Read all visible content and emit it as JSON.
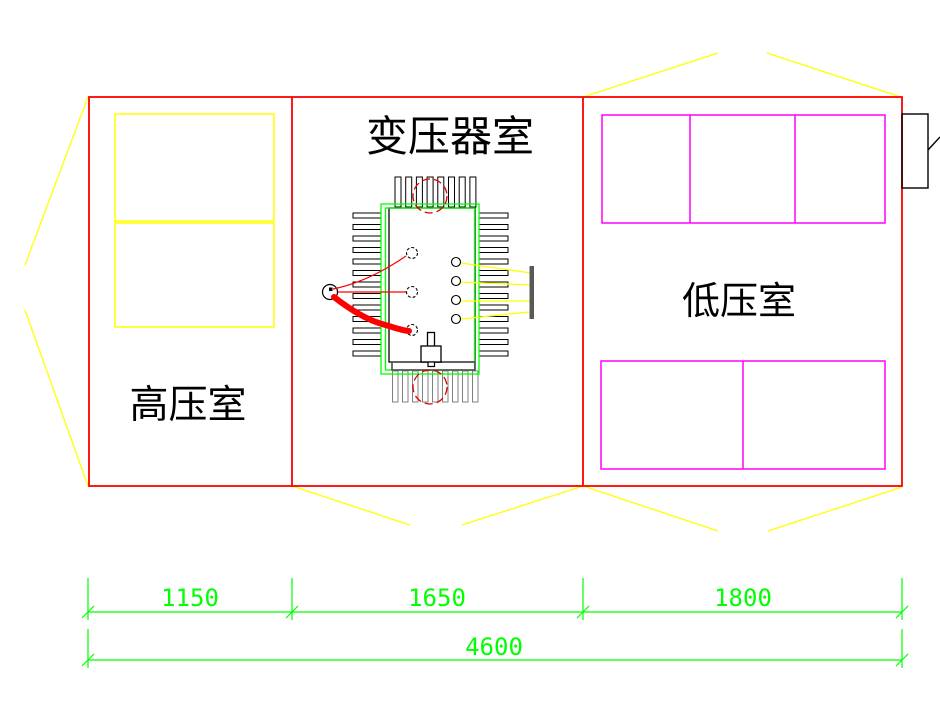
{
  "drawing": {
    "rooms": {
      "high_voltage": "高压室",
      "transformer": "变压器室",
      "low_voltage": "低压室"
    },
    "dimensions": {
      "left_room_width": "1150",
      "middle_room_width": "1650",
      "right_room_width": "1800",
      "total_width": "4600"
    },
    "colors": {
      "wall_outline": "#ff0000",
      "hv_cabinets": "#ffff00",
      "lv_cabinets": "#ff00ff",
      "transformer_enclosure": "#00ff00",
      "dimension_lines": "#00ff00",
      "projection_lines": "#ffff00",
      "cable": "#ff0000",
      "busbar": "#595959",
      "text": "#000000"
    }
  }
}
